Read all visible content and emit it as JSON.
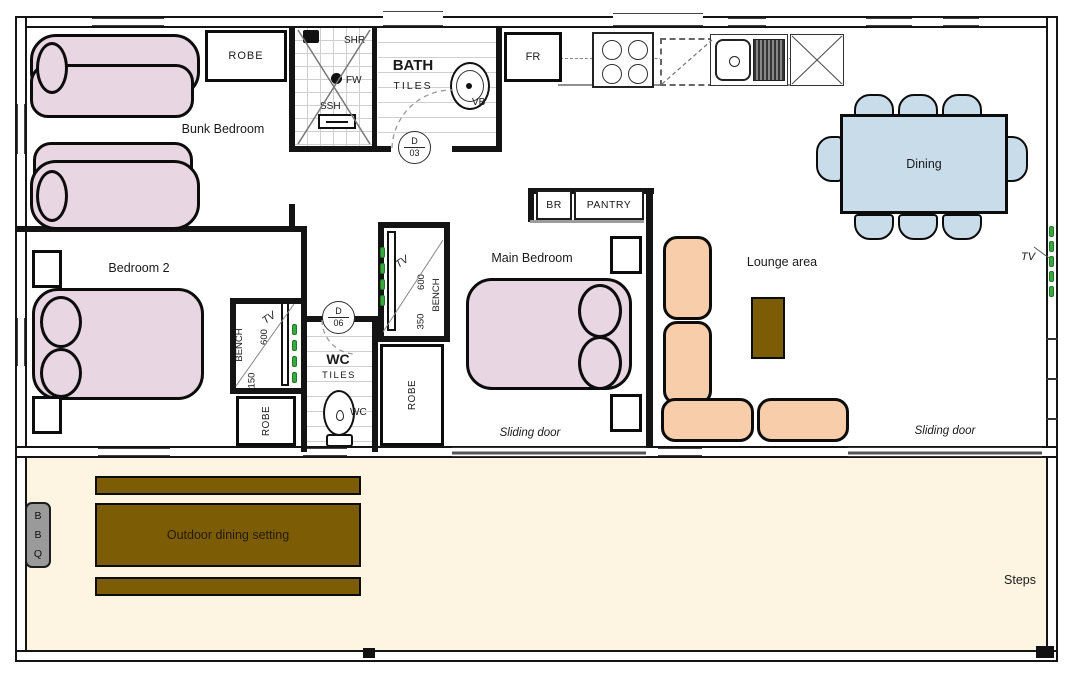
{
  "labels": {
    "bunk_bedroom": "Bunk Bedroom",
    "bedroom2": "Bedroom 2",
    "main_bedroom": "Main Bedroom",
    "lounge": "Lounge area",
    "dining": "Dining",
    "outdoor_dining": "Outdoor dining setting",
    "steps": "Steps",
    "sliding_door_1": "Sliding door",
    "sliding_door_2": "Sliding door",
    "tv_lounge": "TV",
    "tv_bedroom2": "TV",
    "tv_main": "TV"
  },
  "bath": {
    "name": "BATH",
    "tiles": "TILES",
    "shr": "SHR",
    "fw": "FW",
    "ssh": "SSH",
    "vb": "VB"
  },
  "wc": {
    "name": "WC",
    "tiles": "TILES",
    "fixture": "WC"
  },
  "kitchen": {
    "fridge": "FR",
    "br": "BR",
    "pantry": "PANTRY"
  },
  "storage": {
    "robe_bunk": "ROBE",
    "robe_bedroom2": "ROBE",
    "robe_main": "ROBE"
  },
  "bench_bedroom2": {
    "label": "BENCH",
    "dim_a": "600",
    "dim_b": "150"
  },
  "bench_main": {
    "label": "BENCH",
    "dim_a": "600",
    "dim_b": "350"
  },
  "doors": {
    "d03_letter": "D",
    "d03_num": "03",
    "d06_letter": "D",
    "d06_num": "06"
  },
  "bbq": {
    "l1": "B",
    "l2": "B",
    "l3": "Q"
  },
  "colors": {
    "bed_pink": "#e8d6e3",
    "sofa_peach": "#f8cda9",
    "dining_blue": "#c9dcea",
    "timber_brown": "#7d5c06",
    "deck_cream": "#fdf5e2",
    "tv_marker_green": "#3aa83c",
    "bbq_grey": "#9a9a9a"
  }
}
